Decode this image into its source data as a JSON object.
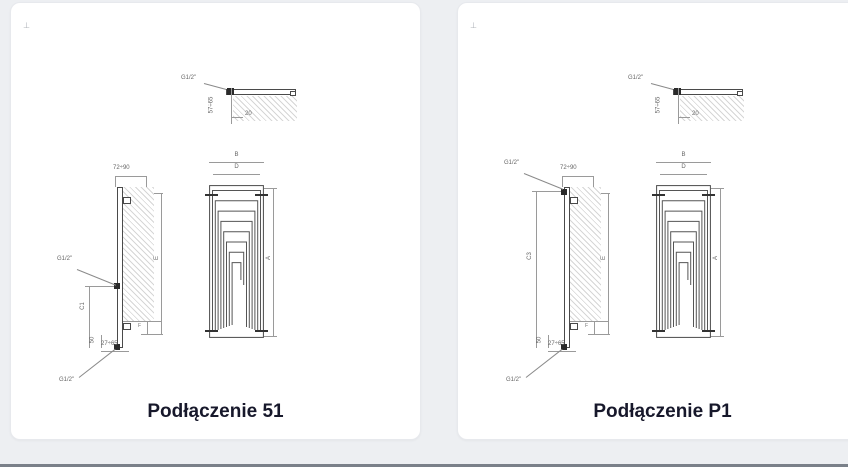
{
  "page": {
    "background_color": "#edeff2",
    "divider_color": "#7a8089"
  },
  "cards": [
    {
      "caption": "Podłączenie 51",
      "corner_mark": "⊥",
      "top_detail": {
        "thread": "G1/2\"",
        "depth_range": "57÷65",
        "offset": "20"
      },
      "side_view": {
        "top_range": "72÷90",
        "height_label": "E",
        "spacing_label": "C1",
        "offset_small": "50",
        "step_label": "F",
        "bottom_range": "27÷65",
        "thread_upper": "G1/2\"",
        "thread_lower": "G1/2\""
      },
      "front_view": {
        "width_label": "B",
        "inner_width_label": "D",
        "height_label": "A"
      }
    },
    {
      "caption": "Podłączenie P1",
      "corner_mark": "⊥",
      "top_detail": {
        "thread": "G1/2\"",
        "depth_range": "57÷65",
        "offset": "20"
      },
      "side_view": {
        "top_range": "72÷90",
        "height_label": "E",
        "spacing_label": "C3",
        "offset_small": "50",
        "step_label": "F",
        "bottom_range": "27÷65",
        "thread_upper": "G1/2\"",
        "thread_lower": "G1/2\""
      },
      "front_view": {
        "width_label": "B",
        "inner_width_label": "D",
        "height_label": "A"
      }
    }
  ]
}
